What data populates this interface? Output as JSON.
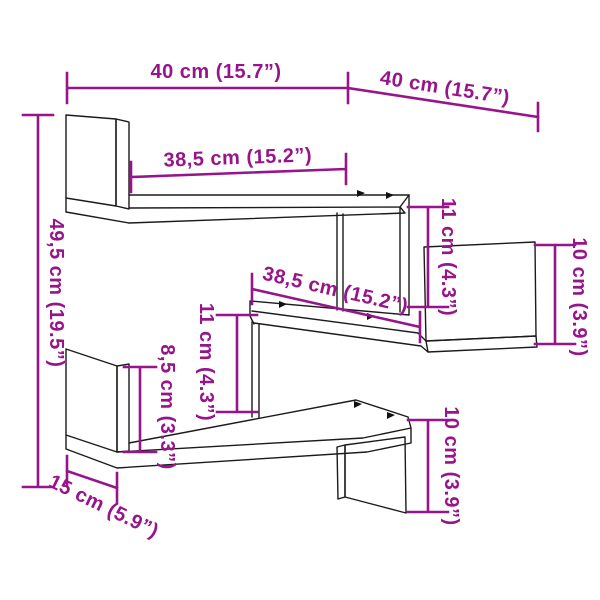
{
  "diagram": {
    "type": "furniture-dimension-drawing",
    "subject": "corner-wall-shelf-3-tier",
    "background_color": "#ffffff",
    "outline_color": "#1b1b1b",
    "accent_color": "#97158B",
    "dims": {
      "width_left": "40 cm (15.7”)",
      "width_right": "40 cm (15.7”)",
      "height_total": "49,5 cm (19.5”)",
      "top_shelf_length": "38,5 cm (15.2”)",
      "middle_shelf_length": "38,5 cm (15.2”)",
      "clearance_top": "11 cm (4.3”)",
      "clearance_middle": "11 cm (4.3”)",
      "clearance_bottom": "8,5 cm (3.3”)",
      "back_panel_right": "10 cm (3.9”)",
      "end_panel_bottom": "10 cm (3.9”)",
      "depth": "15 cm (5.9”)"
    }
  }
}
